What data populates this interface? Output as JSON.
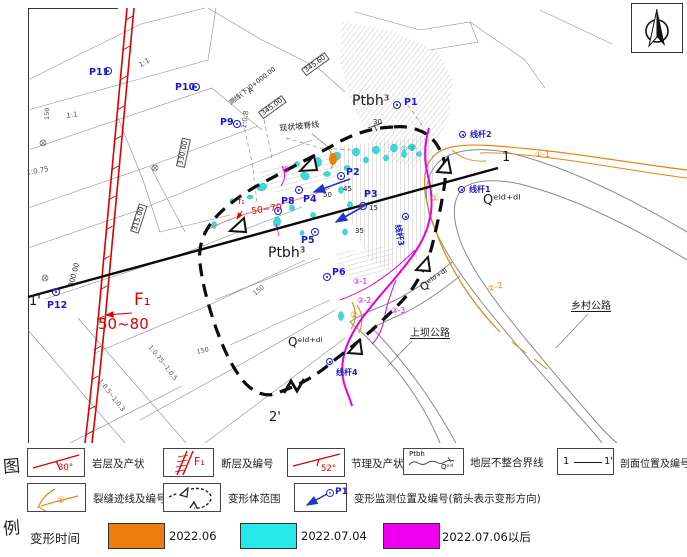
{
  "legend": {
    "col_label_top": "图",
    "col_label_bottom": "例",
    "row1": [
      {
        "name": "strata-attitude",
        "value": "30°",
        "label": "岩层及产状"
      },
      {
        "name": "fault-number",
        "value": "F₁",
        "label": "断层及编号"
      },
      {
        "name": "joint-attitude",
        "value": "52°",
        "label": "节理及产状"
      },
      {
        "name": "unconformity",
        "upper": "Ptbh",
        "lower": "Qᵉˡᵈ",
        "label": "地层不整合界线"
      },
      {
        "name": "section-location",
        "left": "1",
        "right": "1'",
        "label": "剖面位置及编号"
      }
    ],
    "row2": [
      {
        "name": "crack-trace",
        "badge": "①",
        "label": "裂缝迹线及编号"
      },
      {
        "name": "deformation-extent",
        "label": "变形体范围"
      },
      {
        "name": "monitor-point",
        "point": "P1",
        "label": "变形监测位置及编号(箭头表示变形方向)"
      }
    ],
    "time": {
      "title": "变形时间",
      "items": [
        {
          "color": "#ee7d10",
          "label": "2022.06",
          "swatch_x": 108,
          "label_x": 169
        },
        {
          "color": "#26e8e8",
          "label": "2022.07.04",
          "swatch_x": 240,
          "label_x": 301
        },
        {
          "color": "#ee00ee",
          "label": "2022.07.06以后",
          "swatch_x": 383,
          "label_x": 442
        }
      ]
    }
  },
  "map": {
    "labels": [
      {
        "text": "Ptbh³",
        "x": 352,
        "y": 94,
        "size": 14,
        "color": "black",
        "name": "strata-label-ptbh-upper"
      },
      {
        "text": "Ptbh³",
        "x": 268,
        "y": 246,
        "size": 14,
        "color": "black",
        "name": "strata-label-ptbh-center"
      },
      {
        "text": "Qᵉˡᵈ⁺ᵈˡ",
        "x": 483,
        "y": 194,
        "size": 13,
        "color": "black",
        "name": "strata-label-q-right"
      },
      {
        "text": "Qᵉˡᵈ⁺ᵈˡ",
        "x": 288,
        "y": 336,
        "size": 12,
        "color": "black",
        "name": "strata-label-q-bottom"
      },
      {
        "text": "Qᵉˡᵈ⁺ᵈˡ",
        "x": 418,
        "y": 284,
        "size": 11,
        "color": "black",
        "rot": -33,
        "name": "strata-label-q-mid"
      },
      {
        "text": "F₁",
        "x": 134,
        "y": 292,
        "size": 17,
        "color": "red",
        "name": "fault-f1-label"
      },
      {
        "text": "50~80",
        "x": 98,
        "y": 317,
        "size": 15,
        "color": "red",
        "name": "fault-f1-dip"
      },
      {
        "text": "f₁",
        "x": 238,
        "y": 198,
        "size": 9,
        "color": "red",
        "name": "minor-fault-label"
      },
      {
        "text": "50~70",
        "x": 251,
        "y": 208,
        "size": 9,
        "color": "red",
        "rot": -8,
        "name": "minor-fault-dip"
      },
      {
        "text": "1",
        "x": 502,
        "y": 151,
        "size": 13,
        "color": "black",
        "name": "section-end-1"
      },
      {
        "text": "1'",
        "x": 29,
        "y": 295,
        "size": 13,
        "color": "black",
        "name": "section-end-1-prime"
      },
      {
        "text": "2'",
        "x": 269,
        "y": 411,
        "size": 13,
        "color": "black",
        "name": "section-end-2-prime"
      },
      {
        "text": "现状坡脊线",
        "x": 279,
        "y": 125,
        "size": 8,
        "color": "black",
        "rot": -6,
        "name": "ridge-line-label"
      },
      {
        "text": "A",
        "x": 247,
        "y": 90,
        "size": 7,
        "color": "black",
        "rot": -38,
        "name": "survey-point-a"
      },
      {
        "text": "测线(下)0+000.00",
        "x": 228,
        "y": 101,
        "size": 6.5,
        "color": "black",
        "rot": -38,
        "name": "survey-line-label"
      },
      {
        "text": "上坝公路",
        "x": 410,
        "y": 329,
        "size": 10,
        "color": "black",
        "underline": true,
        "name": "road-label-shangba"
      },
      {
        "text": "乡村公路",
        "x": 571,
        "y": 302,
        "size": 10,
        "color": "black",
        "underline": true,
        "name": "road-label-xiangcun"
      },
      {
        "text": "345.60",
        "x": 301,
        "y": 69,
        "size": 7,
        "color": "black",
        "rot": -36,
        "box": true,
        "name": "elevation-345-60"
      },
      {
        "text": "345.00",
        "x": 258,
        "y": 112,
        "size": 7,
        "color": "black",
        "rot": -36,
        "box": true,
        "name": "elevation-345-00"
      },
      {
        "text": "330.00",
        "x": 176,
        "y": 166,
        "size": 7,
        "color": "black",
        "rot": -78,
        "box": true,
        "name": "elevation-330-00"
      },
      {
        "text": "315.00",
        "x": 130,
        "y": 231,
        "size": 7,
        "color": "black",
        "rot": -72,
        "box": true,
        "name": "elevation-315-00"
      },
      {
        "text": "300.00",
        "x": 68,
        "y": 286,
        "size": 7,
        "color": "black",
        "rot": -75,
        "name": "elevation-300-00"
      },
      {
        "text": "1:1",
        "x": 138,
        "y": 63,
        "size": 7,
        "color": "gray",
        "rot": -30,
        "name": "slope-ratio"
      },
      {
        "text": "1:1",
        "x": 66,
        "y": 113,
        "size": 7,
        "color": "gray",
        "rot": -8,
        "name": "slope-ratio"
      },
      {
        "text": "1:0.75",
        "x": 26,
        "y": 170,
        "size": 7,
        "color": "gray",
        "rot": -10,
        "name": "slope-ratio"
      },
      {
        "text": "1:0.8",
        "x": 241,
        "y": 128,
        "size": 7,
        "color": "gray",
        "rot": -82,
        "name": "slope-ratio"
      },
      {
        "text": "1:0.75~1:0.5",
        "x": 152,
        "y": 344,
        "size": 6.5,
        "color": "gray",
        "rot": 52,
        "name": "slope-ratio"
      },
      {
        "text": "1:0.5~1:0.3",
        "x": 102,
        "y": 378,
        "size": 6.5,
        "color": "gray",
        "rot": 52,
        "name": "slope-ratio"
      },
      {
        "text": "150",
        "x": 44,
        "y": 120,
        "size": 6.5,
        "color": "gray",
        "rot": -90,
        "name": "dimension-label"
      },
      {
        "text": "150",
        "x": 196,
        "y": 349,
        "size": 6.5,
        "color": "gray",
        "rot": -12,
        "name": "dimension-label"
      },
      {
        "text": "150",
        "x": 252,
        "y": 292,
        "size": 6.5,
        "color": "gray",
        "rot": -40,
        "name": "dimension-label"
      },
      {
        "text": "30",
        "x": 373,
        "y": 119,
        "size": 7,
        "color": "black",
        "name": "dip-value"
      },
      {
        "text": "50",
        "x": 323,
        "y": 192,
        "size": 7,
        "color": "black",
        "name": "dip-value"
      },
      {
        "text": "45",
        "x": 343,
        "y": 186,
        "size": 7,
        "color": "black",
        "name": "dip-value"
      },
      {
        "text": "15",
        "x": 369,
        "y": 205,
        "size": 7,
        "color": "black",
        "name": "dip-value"
      },
      {
        "text": "35",
        "x": 355,
        "y": 228,
        "size": 7,
        "color": "black",
        "name": "dip-value"
      },
      {
        "text": "①-1",
        "x": 535,
        "y": 151,
        "size": 8,
        "color": "orange",
        "name": "crack-label-1-1"
      },
      {
        "text": "①",
        "x": 431,
        "y": 195,
        "size": 9,
        "color": "orange",
        "name": "crack-label-1"
      },
      {
        "text": "②-2",
        "x": 487,
        "y": 286,
        "size": 8,
        "color": "orange",
        "rot": -18,
        "name": "crack-label-2-2"
      },
      {
        "text": "②",
        "x": 350,
        "y": 312,
        "size": 9,
        "color": "orange",
        "name": "crack-label-2"
      },
      {
        "text": "③",
        "x": 282,
        "y": 167,
        "size": 9,
        "color": "magenta",
        "name": "crack-label-3"
      },
      {
        "text": "③-1",
        "x": 353,
        "y": 278,
        "size": 7.5,
        "color": "magenta",
        "name": "crack-label-3-1"
      },
      {
        "text": "③-2",
        "x": 357,
        "y": 297,
        "size": 7.5,
        "color": "magenta",
        "name": "crack-label-3-2"
      },
      {
        "text": "③-3",
        "x": 391,
        "y": 307,
        "size": 7.5,
        "color": "magenta",
        "name": "crack-label-3-3"
      },
      {
        "text": "①-3",
        "x": 401,
        "y": 146,
        "size": 7,
        "color": "cyan",
        "name": "crack-label-1-3"
      }
    ],
    "points": [
      {
        "id": "P1",
        "cx": 397,
        "cy": 105,
        "lx": 404,
        "ly": 98
      },
      {
        "id": "P2",
        "cx": 341,
        "cy": 176,
        "lx": 346,
        "ly": 168
      },
      {
        "id": "P3",
        "cx": 363,
        "cy": 206,
        "lx": 364,
        "ly": 190
      },
      {
        "id": "P4",
        "cx": 299,
        "cy": 190,
        "lx": 303,
        "ly": 195
      },
      {
        "id": "P5",
        "cx": 315,
        "cy": 232,
        "lx": 301,
        "ly": 236
      },
      {
        "id": "P6",
        "cx": 327,
        "cy": 277,
        "lx": 332,
        "ly": 268
      },
      {
        "id": "P8",
        "cx": 278,
        "cy": 211,
        "lx": 281,
        "ly": 197
      },
      {
        "id": "P9",
        "cx": 237,
        "cy": 124,
        "lx": 220,
        "ly": 118
      },
      {
        "id": "P10",
        "cx": 196,
        "cy": 87,
        "lx": 175,
        "ly": 83
      },
      {
        "id": "P11",
        "cx": 108,
        "cy": 71,
        "lx": 89,
        "ly": 68
      },
      {
        "id": "P12",
        "cx": 56,
        "cy": 292,
        "lx": 47,
        "ly": 301
      },
      {
        "id": "线杆1",
        "cx": 462,
        "cy": 190,
        "lx": 469,
        "ly": 186,
        "small": true
      },
      {
        "id": "线杆2",
        "cx": 463,
        "cy": 135,
        "lx": 470,
        "ly": 131,
        "small": true
      },
      {
        "id": "线杆3",
        "cx": 406,
        "cy": 217,
        "lx": 401,
        "ly": 224,
        "rot": 80,
        "small": true
      },
      {
        "id": "线杆4",
        "cx": 330,
        "cy": 362,
        "lx": 336,
        "ly": 369,
        "small": true
      }
    ]
  }
}
